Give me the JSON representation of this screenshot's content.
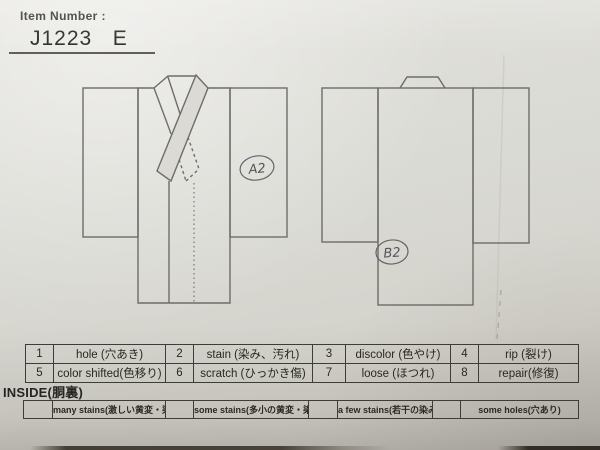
{
  "header": {
    "item_number_label": "Item Number :",
    "item_number_value": "J1223   E"
  },
  "annotations": {
    "front_mark": "A2",
    "back_mark": "B2"
  },
  "defect_table": {
    "rows": [
      {
        "n1": "1",
        "l1": "hole (穴あき)",
        "n2": "2",
        "l2": "stain (染み、汚れ)",
        "n3": "3",
        "l3": "discolor (色やけ)",
        "n4": "4",
        "l4": "rip (裂け)"
      },
      {
        "n1": "5",
        "l1": "color shifted(色移り)",
        "n2": "6",
        "l2": "scratch (ひっかき傷)",
        "n3": "7",
        "l3": "loose (ほつれ)",
        "n4": "8",
        "l4": "repair(修復)"
      }
    ]
  },
  "inside_section": {
    "title": "INSIDE(胴裏)",
    "options": [
      "many stains(激しい黄変・染み)",
      "some stains(多小の黄変・染み)",
      "a few stains(若干の染み)",
      "some holes(穴あり)"
    ]
  },
  "colors": {
    "paper": "#dadad4",
    "table_line": "#3c3c38",
    "pencil_line": "#6e6d69",
    "handwriting": "#54545c"
  }
}
